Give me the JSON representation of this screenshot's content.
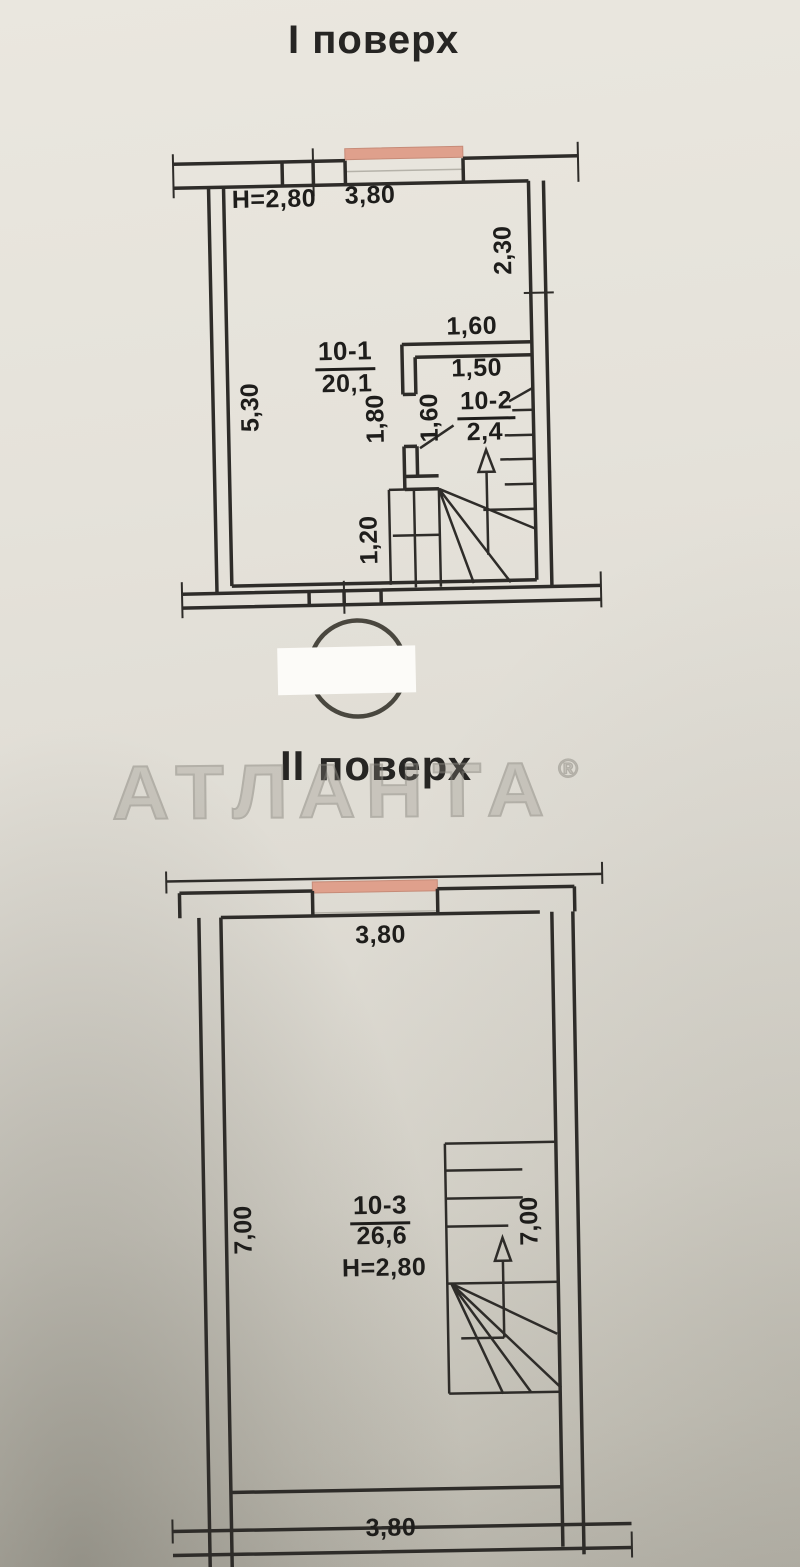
{
  "floor1": {
    "title": "І поверх",
    "height_label": "Н=2,80",
    "room_main": {
      "number": "10-1",
      "area": "20,1"
    },
    "room_stair": {
      "number": "10-2",
      "area": "2,4"
    },
    "dims": {
      "top_window": "3,80",
      "right_upper": "2,30",
      "left": "5,30",
      "niche_top": "1,60",
      "stair_top": "1,50",
      "door_height": "1,80",
      "door_width": "1,60",
      "stair_left": "1,20"
    }
  },
  "floor2": {
    "title": "ІІ поверх",
    "height_label": "Н=2,80",
    "room": {
      "number": "10-3",
      "area": "26,6"
    },
    "dims": {
      "top_window": "3,80",
      "left": "7,00",
      "stair": "7,00",
      "bottom": "3,80"
    }
  },
  "watermark": {
    "text": "АТЛАНТА",
    "registered": "®"
  },
  "colors": {
    "paper": "#e3e0d8",
    "linework": "#2e2c29",
    "window_accent": "#dfa08c",
    "window_edge": "#c68b78",
    "watermark_outline": "#8f8c84",
    "stamp_ink": "#39362f"
  }
}
